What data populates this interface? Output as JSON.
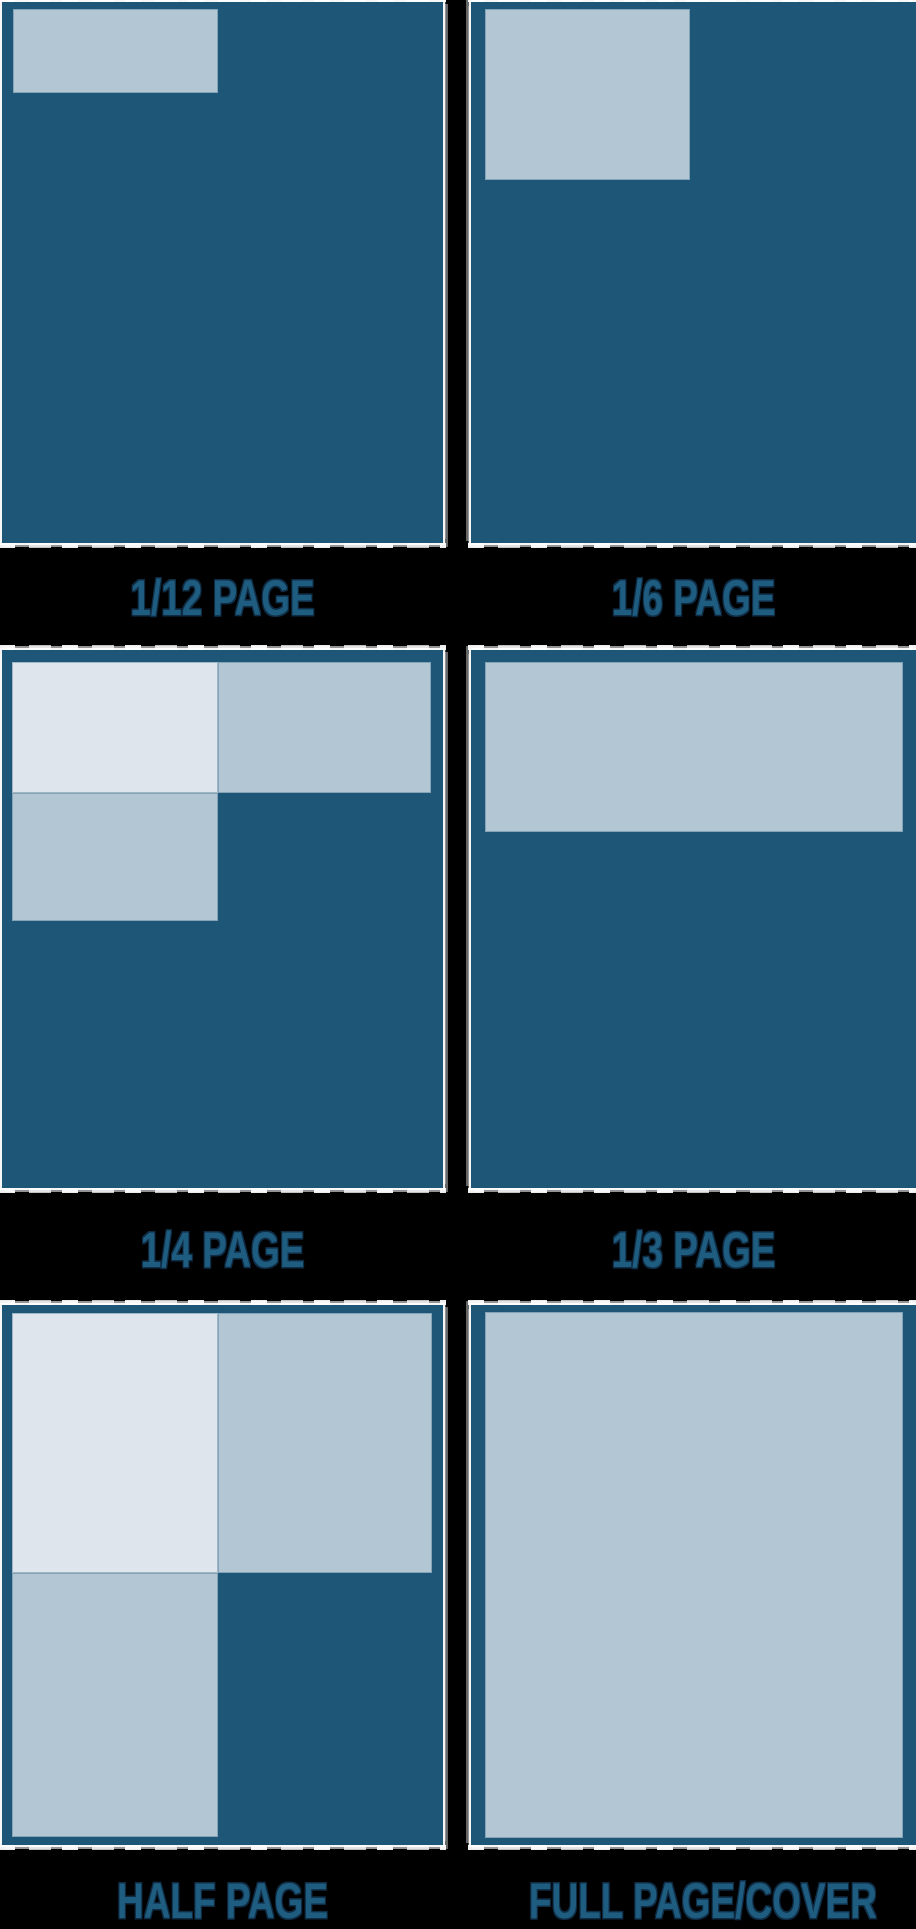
{
  "title": "Magazine ad size diagram",
  "colors": {
    "background": "#000000",
    "page": "#1d5677",
    "ad": "#b2c7d3",
    "ad_highlight": "#dee5ec",
    "label_text": "#1f5d80",
    "edge_fringe": "#ffffff"
  },
  "panels": [
    {
      "name": "panel-1-12-page",
      "label": "1/12 PAGE",
      "box": {
        "left": 2,
        "top": 2,
        "width": 441,
        "height": 541
      },
      "label_top": 576,
      "shapes": [
        {
          "name": "ad-region-1-12",
          "tone": "ad",
          "left": 11,
          "top": 7,
          "width": 205,
          "height": 84
        }
      ]
    },
    {
      "name": "panel-1-6-page",
      "label": "1/6 PAGE",
      "box": {
        "left": 471,
        "top": 2,
        "width": 445,
        "height": 541
      },
      "label_top": 576,
      "shapes": [
        {
          "name": "ad-region-1-6",
          "tone": "ad",
          "left": 14,
          "top": 7,
          "width": 205,
          "height": 171
        }
      ]
    },
    {
      "name": "panel-1-4-page",
      "label": "1/4 PAGE",
      "box": {
        "left": 2,
        "top": 650,
        "width": 441,
        "height": 538
      },
      "label_top": 1228,
      "shapes": [
        {
          "name": "ad-region-1-4-top-left",
          "tone": "highlight",
          "left": 10,
          "top": 12,
          "width": 206,
          "height": 131
        },
        {
          "name": "ad-region-1-4-top-right",
          "tone": "ad",
          "left": 216,
          "top": 12,
          "width": 213,
          "height": 131
        },
        {
          "name": "ad-region-1-4-bottom-left",
          "tone": "ad",
          "left": 10,
          "top": 143,
          "width": 206,
          "height": 128
        }
      ]
    },
    {
      "name": "panel-1-3-page",
      "label": "1/3 PAGE",
      "box": {
        "left": 471,
        "top": 650,
        "width": 445,
        "height": 538
      },
      "label_top": 1228,
      "shapes": [
        {
          "name": "ad-region-1-3",
          "tone": "ad",
          "left": 14,
          "top": 12,
          "width": 418,
          "height": 170
        }
      ]
    },
    {
      "name": "panel-half-page",
      "label": "HALF PAGE",
      "box": {
        "left": 2,
        "top": 1305,
        "width": 441,
        "height": 540
      },
      "label_top": 1879,
      "shapes": [
        {
          "name": "ad-region-half-top-left",
          "tone": "highlight",
          "left": 10,
          "top": 8,
          "width": 206,
          "height": 260
        },
        {
          "name": "ad-region-half-top-right",
          "tone": "ad",
          "left": 216,
          "top": 8,
          "width": 214,
          "height": 260
        },
        {
          "name": "ad-region-half-bottom-left",
          "tone": "ad",
          "left": 10,
          "top": 268,
          "width": 206,
          "height": 264
        }
      ]
    },
    {
      "name": "panel-full-page-cover",
      "label": "FULL PAGE/COVER",
      "box": {
        "left": 471,
        "top": 1305,
        "width": 445,
        "height": 540
      },
      "label_top": 1879,
      "shapes": [
        {
          "name": "ad-region-full-page",
          "tone": "ad",
          "left": 14,
          "top": 7,
          "width": 418,
          "height": 526
        }
      ]
    }
  ]
}
